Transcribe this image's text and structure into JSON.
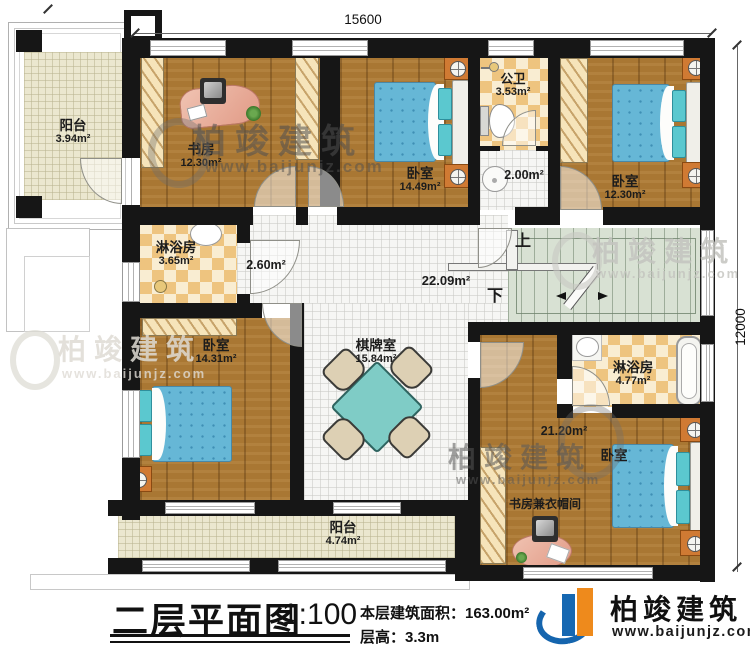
{
  "dimensions": {
    "width_mm": "15600",
    "height_mm": "12000"
  },
  "stairs": {
    "up_label": "上",
    "down_label": "下"
  },
  "rooms": {
    "balcony_top": {
      "name": "阳台",
      "area": "3.94m²"
    },
    "study": {
      "name": "书房",
      "area": "12.30m²"
    },
    "bedroom_top_middle": {
      "name": "卧室",
      "area": "14.49m²"
    },
    "public_bathroom": {
      "name": "公卫",
      "area": "3.53m²"
    },
    "washbasin_lobby": {
      "area": "2.00m²"
    },
    "bedroom_top_right": {
      "name": "卧室",
      "area": "12.30m²"
    },
    "shower_room_left": {
      "name": "淋浴房",
      "area": "3.65m²"
    },
    "corridor": {
      "area": "2.60m²"
    },
    "hall": {
      "area": "22.09m²"
    },
    "bedroom_left": {
      "name": "卧室",
      "area": "14.31m²"
    },
    "chess_room": {
      "name": "棋牌室",
      "area": "15.84m²"
    },
    "shower_room_right": {
      "name": "淋浴房",
      "area": "4.77m²"
    },
    "bedroom_bottom_right": {
      "name": "卧室",
      "area": "21.20m²"
    },
    "study_cloakroom": {
      "name": "书房兼衣帽间"
    },
    "balcony_bottom": {
      "name": "阳台",
      "area": "4.74m²"
    }
  },
  "title_block": {
    "title": "二层平面图",
    "scale": "1:100",
    "floor_area": "本层建筑面积：163.00m²",
    "floor_height": "层高：3.3m"
  },
  "brand": {
    "name": "柏竣建筑",
    "website": "www.baijunjz.com"
  },
  "watermark": {
    "name": "柏竣建筑",
    "website": "www.baijunjz.com"
  }
}
